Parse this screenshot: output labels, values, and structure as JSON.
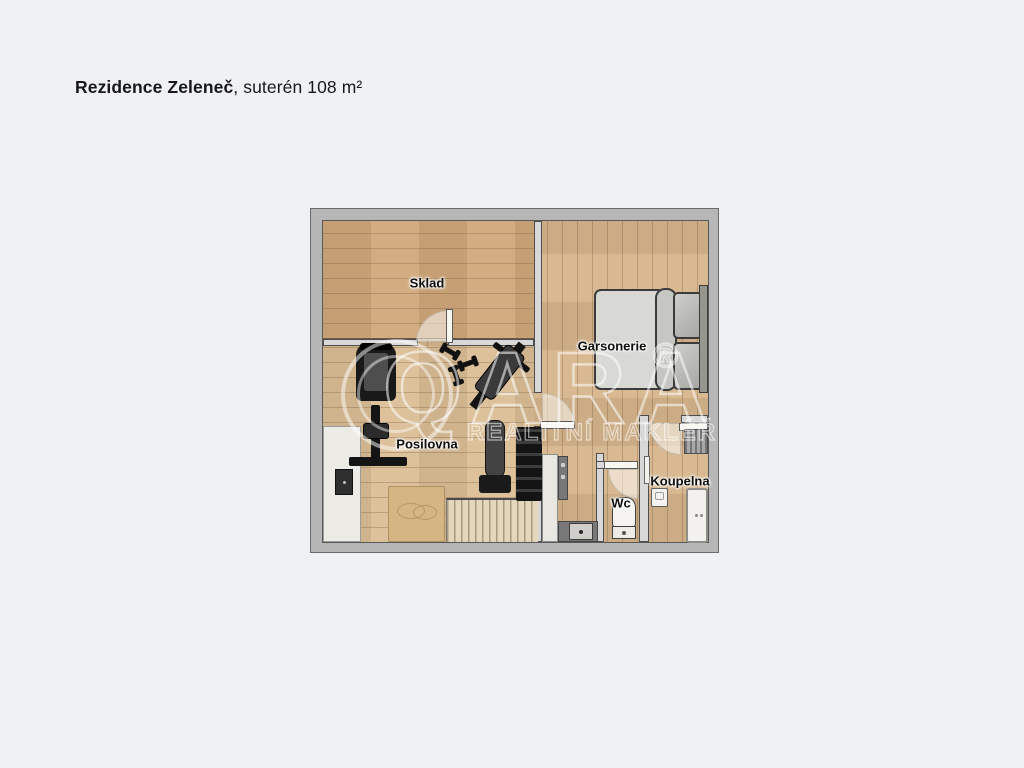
{
  "header": {
    "title_bold": "Rezidence Zeleneč",
    "title_rest": ", suterén 108 m²"
  },
  "floorplan": {
    "rooms": [
      {
        "id": "sklad",
        "label": "Sklad"
      },
      {
        "id": "garsonerie",
        "label": "Garsonerie"
      },
      {
        "id": "posilovna",
        "label": "Posilovna"
      },
      {
        "id": "wc",
        "label": "Wc"
      },
      {
        "id": "koupelna",
        "label": "Koupelna"
      }
    ],
    "furniture": [
      "double-bed",
      "washing-machine",
      "towel-radiator",
      "bathroom-sink",
      "bathtub",
      "toilet",
      "kitchenette-cabinet",
      "kitchenette-counter",
      "kitchenette-sink",
      "wardrobe",
      "stove-panel",
      "rug",
      "staircase",
      "treadmill",
      "multi-gym",
      "dumbbells",
      "incline-bench",
      "flat-bench",
      "dumbbell-rack"
    ],
    "colors": {
      "page_background": "#eff1f5",
      "outer_wall": "#b6b6b6",
      "inner_wall": "#d8d8d8",
      "wood_floor": "#d6b58b",
      "label_text": "#0d0d0d",
      "watermark": "rgba(255,255,255,0.55)"
    }
  },
  "watermark": {
    "brand": "QARA",
    "subtitle": "REALITNÍ MAKLÉŘ",
    "registered": "®"
  }
}
